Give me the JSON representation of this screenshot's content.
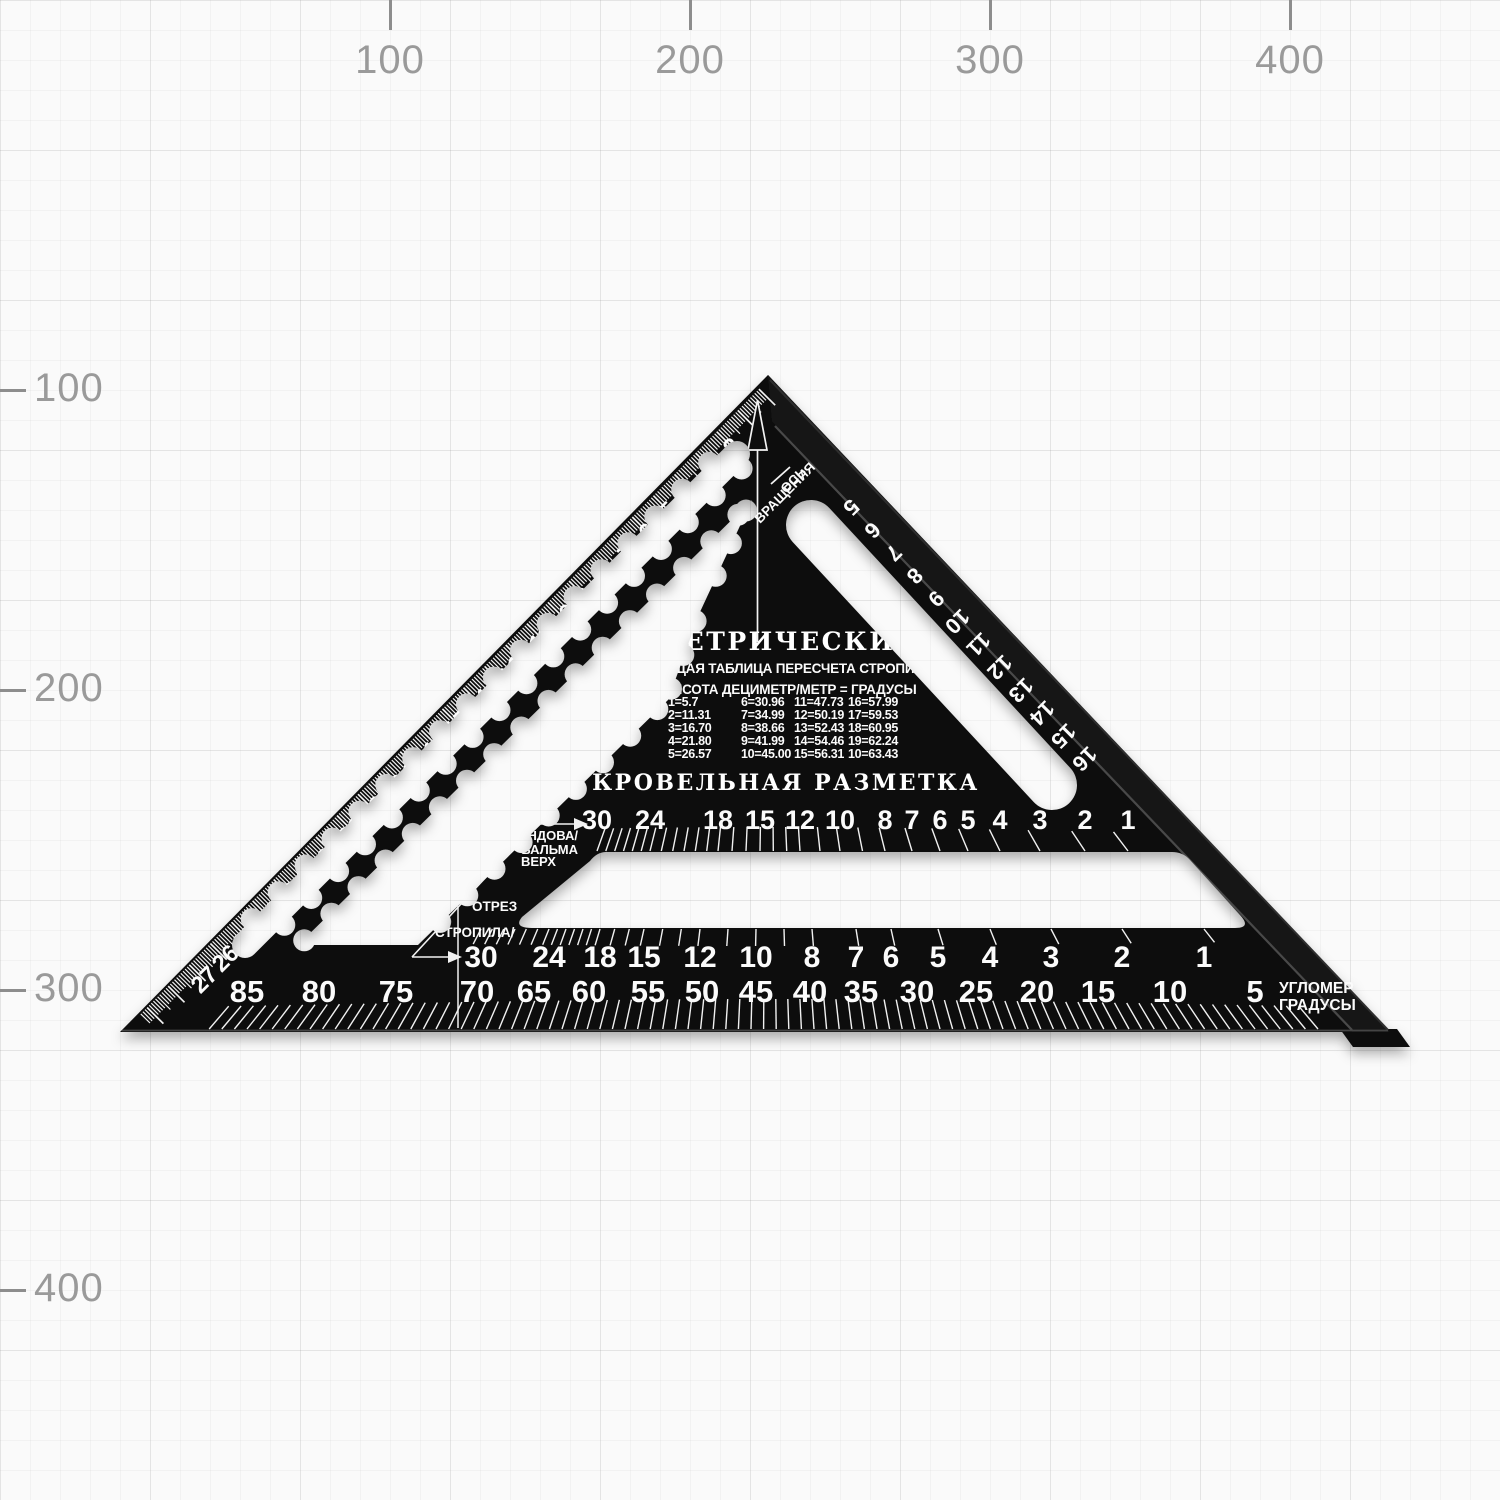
{
  "axes": {
    "top": [
      {
        "label": "100",
        "x": 390
      },
      {
        "label": "200",
        "x": 690
      },
      {
        "label": "300",
        "x": 990
      },
      {
        "label": "400",
        "x": 1290
      }
    ],
    "left": [
      {
        "label": "100",
        "y": 390
      },
      {
        "label": "200",
        "y": 690
      },
      {
        "label": "300",
        "y": 990
      },
      {
        "label": "400",
        "y": 1290
      }
    ]
  },
  "square": {
    "title": "МЕТРИЧЕСКИЙ",
    "subtitle1": "ОБЩАЯ ТАБЛИЦА ПЕРЕСЧЕТА СТРОПИЛ",
    "subtitle2": "ВЫСОТА ДЕЦИМЕТР/МЕТР = ГРАДУСЫ",
    "conversion_table": {
      "columns": [
        [
          "1=5.7",
          "2=11.31",
          "3=16.70",
          "4=21.80",
          "5=26.57"
        ],
        [
          "6=30.96",
          "7=34.99",
          "8=38.66",
          "9=41.99",
          "10=45.00"
        ],
        [
          "11=47.73",
          "12=50.19",
          "13=52.43",
          "14=54.46",
          "15=56.31"
        ],
        [
          "16=57.99",
          "17=59.53",
          "18=60.95",
          "19=62.24",
          "10=63.43"
        ]
      ]
    },
    "roofing_title": "КРОВЕЛЬНАЯ РАЗМЕТКА",
    "pivot_label": {
      "line1": "ОСЬ",
      "line2": "ВРАЩЕНИЯ"
    },
    "valley_label": {
      "line1": "ЕНДОВА/",
      "line2": "ВАЛЬМА",
      "line3": "ВЕРХ"
    },
    "cut_label": "ОТРЕЗ",
    "rafter_label": "СТРОПИЛА/",
    "protractor_label": {
      "line1": "УГЛОМЕР",
      "line2": "ГРАДУСЫ"
    },
    "hypotenuse_scale": {
      "values": [
        "2",
        "3",
        "4",
        "5",
        "6",
        "7",
        "8",
        "9",
        "10",
        "11",
        "12",
        "13",
        "14",
        "15",
        "16",
        "17",
        "18",
        "19",
        "20",
        "21",
        "22",
        "23",
        "24",
        "25",
        "26",
        "27"
      ]
    },
    "slot_scale": {
      "values": [
        "5",
        "6",
        "7",
        "8",
        "9",
        "10",
        "11",
        "12",
        "13",
        "14",
        "15",
        "16"
      ]
    },
    "roof_scale_top": [
      {
        "label": "30",
        "x": 597
      },
      {
        "label": "24",
        "x": 650
      },
      {
        "label": "18",
        "x": 718
      },
      {
        "label": "15",
        "x": 760
      },
      {
        "label": "12",
        "x": 800
      },
      {
        "label": "10",
        "x": 840
      },
      {
        "label": "8",
        "x": 885
      },
      {
        "label": "7",
        "x": 912
      },
      {
        "label": "6",
        "x": 940
      },
      {
        "label": "5",
        "x": 968
      },
      {
        "label": "4",
        "x": 1000
      },
      {
        "label": "3",
        "x": 1040
      },
      {
        "label": "2",
        "x": 1085
      },
      {
        "label": "1",
        "x": 1128
      }
    ],
    "roof_scale_bottom": [
      {
        "label": "30",
        "x": 481
      },
      {
        "label": "24",
        "x": 549
      },
      {
        "label": "18",
        "x": 600
      },
      {
        "label": "15",
        "x": 644
      },
      {
        "label": "12",
        "x": 700
      },
      {
        "label": "10",
        "x": 756
      },
      {
        "label": "8",
        "x": 812
      },
      {
        "label": "7",
        "x": 856
      },
      {
        "label": "6",
        "x": 891
      },
      {
        "label": "5",
        "x": 938
      },
      {
        "label": "4",
        "x": 990
      },
      {
        "label": "3",
        "x": 1051
      },
      {
        "label": "2",
        "x": 1122
      },
      {
        "label": "1",
        "x": 1204
      }
    ],
    "degree_scale": [
      {
        "label": "85",
        "x": 247
      },
      {
        "label": "80",
        "x": 319
      },
      {
        "label": "75",
        "x": 396
      },
      {
        "label": "70",
        "x": 477
      },
      {
        "label": "65",
        "x": 534
      },
      {
        "label": "60",
        "x": 589
      },
      {
        "label": "55",
        "x": 648
      },
      {
        "label": "50",
        "x": 702
      },
      {
        "label": "45",
        "x": 756
      },
      {
        "label": "40",
        "x": 810
      },
      {
        "label": "35",
        "x": 861
      },
      {
        "label": "30",
        "x": 917
      },
      {
        "label": "25",
        "x": 976
      },
      {
        "label": "20",
        "x": 1037
      },
      {
        "label": "15",
        "x": 1098
      },
      {
        "label": "10",
        "x": 1170
      },
      {
        "label": "5",
        "x": 1255
      }
    ]
  },
  "colors": {
    "body": "#0d0d0d",
    "flange": "#171717",
    "marking": "#f5f5f5",
    "paper": "#fafafa",
    "axis_text": "#9a9a9a",
    "seam": "#4a4a4a"
  }
}
